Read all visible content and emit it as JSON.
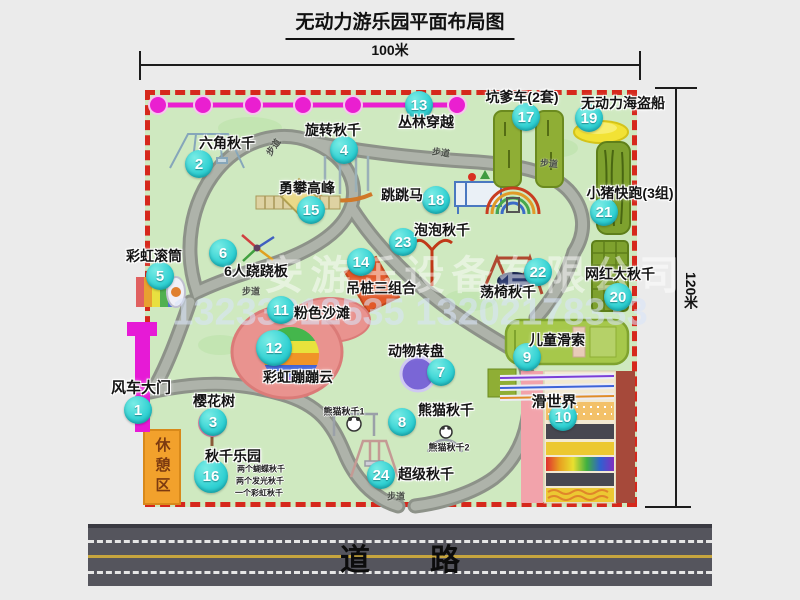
{
  "title": "无动力游乐园平面布局图",
  "dimensions": {
    "width": "100米",
    "height": "120米"
  },
  "road": {
    "label": "道　　路"
  },
  "watermark": {
    "company": "安游乐设备有限公司",
    "phone": "13233812535 13202178333"
  },
  "rest_area": {
    "label": "休憩区"
  },
  "colors": {
    "badge": "#2fd0d2",
    "park_green": "#cfe9c0",
    "border_red": "#d6281c",
    "gate_magenta": "#e61ad6",
    "road_gray": "#55555d",
    "chain_magenta": "#ea1fd0"
  },
  "locations": [
    {
      "n": "1",
      "t": "风车大门",
      "bx": 138,
      "by": 410,
      "lx": 141,
      "ly": 387,
      "fs": 15
    },
    {
      "n": "2",
      "t": "六角秋千",
      "bx": 199,
      "by": 164,
      "lx": 227,
      "ly": 143
    },
    {
      "n": "3",
      "t": "樱花树",
      "bx": 213,
      "by": 422,
      "lx": 214,
      "ly": 401
    },
    {
      "n": "4",
      "t": "旋转秋千",
      "bx": 344,
      "by": 150,
      "lx": 333,
      "ly": 130
    },
    {
      "n": "5",
      "t": "彩虹滚筒",
      "bx": 160,
      "by": 276,
      "lx": 154,
      "ly": 256
    },
    {
      "n": "6",
      "t": "6人跷跷板",
      "bx": 223,
      "by": 253,
      "lx": 256,
      "ly": 271
    },
    {
      "n": "7",
      "t": "动物转盘",
      "bx": 441,
      "by": 372,
      "lx": 416,
      "ly": 351
    },
    {
      "n": "8",
      "t": "熊猫秋千",
      "bx": 402,
      "by": 422,
      "lx": 446,
      "ly": 410
    },
    {
      "n": "9",
      "t": "儿童滑索",
      "bx": 527,
      "by": 357,
      "lx": 557,
      "ly": 340
    },
    {
      "n": "10",
      "t": "滑世界",
      "bx": 563,
      "by": 417,
      "lx": 554,
      "ly": 401,
      "fs": 15
    },
    {
      "n": "11",
      "t": "粉色沙滩",
      "bx": 281,
      "by": 310,
      "lx": 322,
      "ly": 313
    },
    {
      "n": "12",
      "t": "彩虹蹦蹦云",
      "bx": 274,
      "by": 348,
      "lx": 298,
      "ly": 377,
      "s": 36
    },
    {
      "n": "13",
      "t": "丛林穿越",
      "bx": 419,
      "by": 105,
      "lx": 426,
      "ly": 122
    },
    {
      "n": "14",
      "t": "吊桩三组合",
      "bx": 361,
      "by": 262,
      "lx": 381,
      "ly": 288
    },
    {
      "n": "15",
      "t": "勇攀高峰",
      "bx": 311,
      "by": 210,
      "lx": 307,
      "ly": 188
    },
    {
      "n": "16",
      "t": "秋千乐园",
      "bx": 211,
      "by": 476,
      "lx": 233,
      "ly": 456,
      "s": 34
    },
    {
      "n": "17",
      "t": "坑爹车(2套)",
      "bx": 526,
      "by": 117,
      "lx": 522,
      "ly": 97
    },
    {
      "n": "18",
      "t": "跳跳马",
      "bx": 436,
      "by": 200,
      "lx": 402,
      "ly": 195
    },
    {
      "n": "19",
      "t": "无动力海盗船",
      "bx": 589,
      "by": 118,
      "lx": 623,
      "ly": 103
    },
    {
      "n": "20",
      "t": "网红大秋千",
      "bx": 618,
      "by": 297,
      "lx": 620,
      "ly": 274
    },
    {
      "n": "21",
      "t": "小猪快跑(3组)",
      "bx": 604,
      "by": 212,
      "lx": 630,
      "ly": 193
    },
    {
      "n": "22",
      "t": "荡椅秋千",
      "bx": 538,
      "by": 272,
      "lx": 508,
      "ly": 292
    },
    {
      "n": "23",
      "t": "泡泡秋千",
      "bx": 403,
      "by": 242,
      "lx": 442,
      "ly": 230
    },
    {
      "n": "24",
      "t": "超级秋千",
      "bx": 381,
      "by": 475,
      "lx": 426,
      "ly": 474
    }
  ],
  "sub_labels": [
    {
      "t": "熊猫秋千1",
      "x": 344,
      "y": 411,
      "fs": 9
    },
    {
      "t": "熊猫秋千2",
      "x": 449,
      "y": 447,
      "fs": 9
    },
    {
      "t": "两个蝴蝶秋千",
      "x": 261,
      "y": 469,
      "fs": 8
    },
    {
      "t": "两个发光秋千",
      "x": 260,
      "y": 481,
      "fs": 8
    },
    {
      "t": "一个彩虹秋千",
      "x": 259,
      "y": 493,
      "fs": 8
    }
  ],
  "path_labels": [
    {
      "t": "步道",
      "x": 273,
      "y": 147,
      "r": -55
    },
    {
      "t": "步道",
      "x": 441,
      "y": 152,
      "r": 8
    },
    {
      "t": "步道",
      "x": 549,
      "y": 163,
      "r": 5
    },
    {
      "t": "步道",
      "x": 251,
      "y": 291,
      "r": 0
    },
    {
      "t": "步道",
      "x": 396,
      "y": 496,
      "r": 0
    }
  ]
}
